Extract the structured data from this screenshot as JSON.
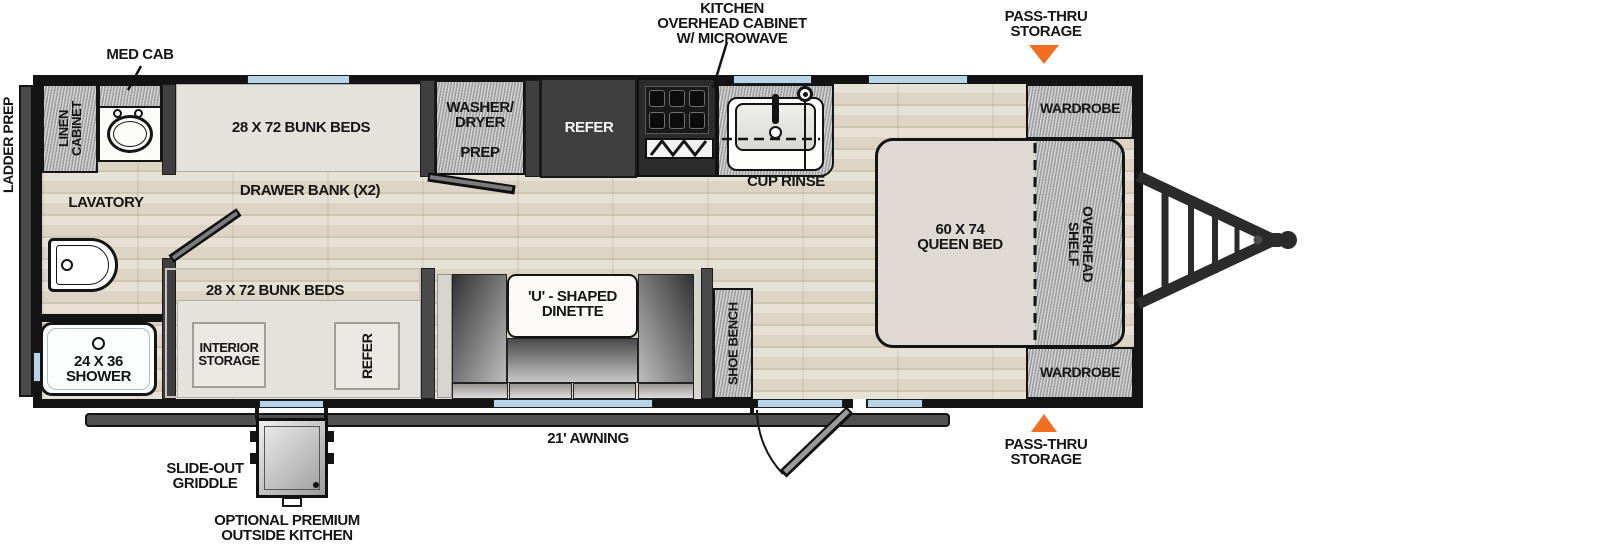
{
  "colors": {
    "accent_orange": "#F26E21",
    "window_blue": "#B9D4E7",
    "wall_black": "#141414",
    "cabinet_gray": "#B7B7B7",
    "appliance_dark": "#3F3F3F",
    "floor_wood": "#E0D8CA"
  },
  "callouts": {
    "med_cab": "MED CAB",
    "kitchen_overhead": "KITCHEN\nOVERHEAD CABINET\nW/ MICROWAVE",
    "pass_thru_top": "PASS-THRU\nSTORAGE",
    "pass_thru_bottom": "PASS-THRU\nSTORAGE",
    "ladder_prep": "LADDER PREP",
    "cup_rinse": "CUP RINSE",
    "awning": "21' AWNING",
    "slide_out_griddle": "SLIDE-OUT\nGRIDDLE",
    "outside_kitchen": "OPTIONAL PREMIUM\nOUTSIDE KITCHEN"
  },
  "rooms": {
    "linen_cabinet": "LINEN\nCABINET",
    "lavatory": "LAVATORY",
    "shower": "24 X 36\nSHOWER",
    "bunk_top": "28 X 72 BUNK BEDS",
    "drawer_bank": "DRAWER BANK (X2)",
    "washer_dryer": "WASHER/\nDRYER",
    "washer_prep": "PREP",
    "refer_kitchen": "REFER",
    "wardrobe_top": "WARDROBE",
    "queen_bed": "60 X 74\nQUEEN BED",
    "overhead_shelf": "OVERHEAD\nSHELF",
    "wardrobe_bottom": "WARDROBE",
    "bunk_bottom": "28 X 72 BUNK BEDS",
    "interior_storage": "INTERIOR\nSTORAGE",
    "refer_bunk": "REFER",
    "dinette": "'U' - SHAPED\nDINETTE",
    "shoe_bench": "SHOE BENCH"
  }
}
